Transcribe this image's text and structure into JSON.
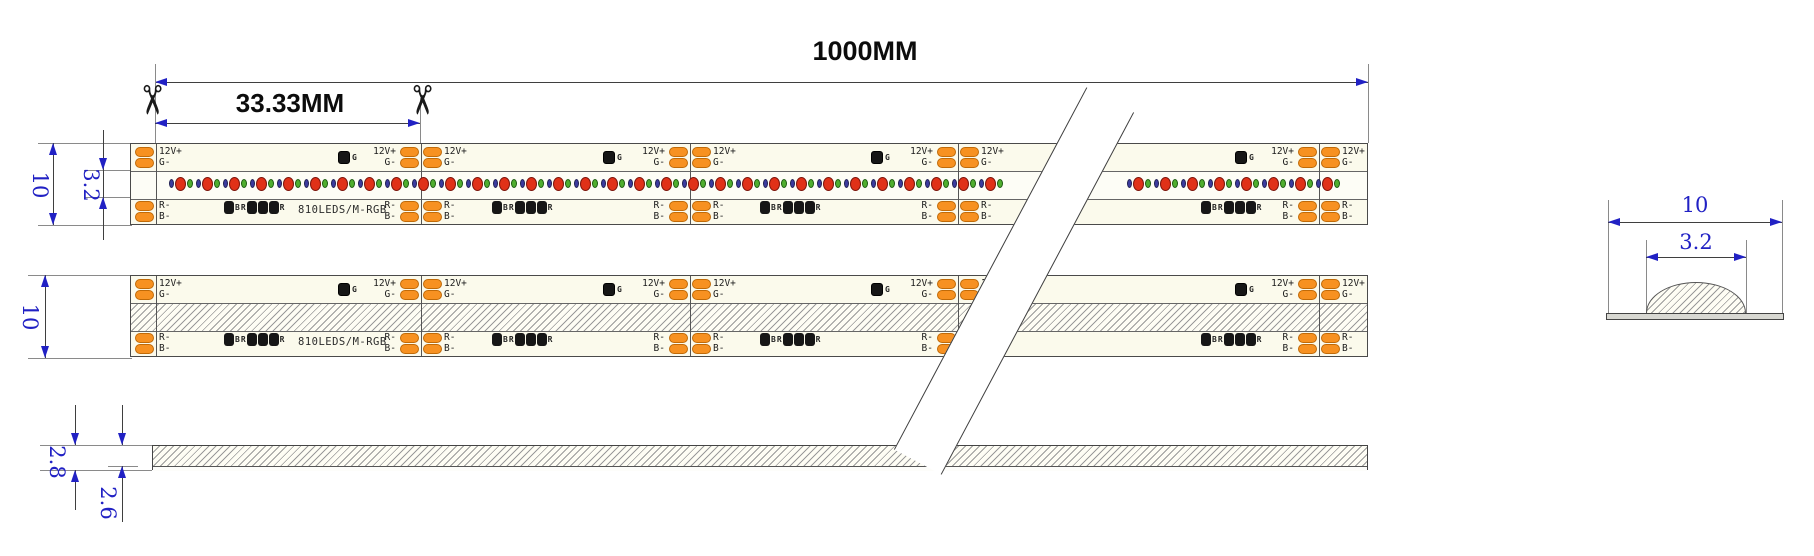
{
  "drawing": {
    "total_length_label": "1000MM",
    "cut_unit_label": "33.33MM",
    "strip1_width_label": "10",
    "led_band_width_label": "3.2",
    "strip2_width_label": "10",
    "profile_height_label": "2.8",
    "profile_glue_label": "2.6",
    "section_width_label": "10",
    "section_dome_label": "3.2"
  },
  "icons": {
    "scissors": "✂"
  },
  "strip": {
    "pads_top": [
      "12V+",
      "G-"
    ],
    "pads_bottom": [
      "R-",
      "B-"
    ],
    "chip_label": "G",
    "spec": "810LEDS/M-RGB",
    "resistor_pattern": [
      "chip",
      "B",
      "R",
      "chip",
      "chip",
      "chip",
      "R"
    ]
  },
  "colors": {
    "dimension_blue": "#2121c4",
    "pad_orange": "#f79121",
    "pad_border": "#c06a08",
    "strip_body": "#fbfaec",
    "led_band_bg": "#fdfdf6",
    "led_red": "#e03118",
    "led_green": "#4fae2e",
    "led_blue": "#3b3b9e",
    "component_black": "#161616"
  },
  "geometry": {
    "strip_x": 130,
    "strip_w": 1238,
    "strip_h": 82,
    "strip1_y": 143,
    "strip2_y": 275,
    "zone1_end": 27,
    "zone2_end": 55,
    "left_cut_rel": 25,
    "boundaries": [
      420,
      689,
      957,
      1318
    ],
    "pad_row_tops": [
      3,
      14,
      57,
      68
    ],
    "led_runs": [
      [
        168,
        1005
      ],
      [
        1126,
        1344
      ]
    ],
    "led_pitch": 27,
    "chip_xs": [
      343,
      608,
      876,
      1240
    ],
    "resistor_xs": [
      260,
      528,
      796,
      1237
    ],
    "spec_x": 297
  }
}
